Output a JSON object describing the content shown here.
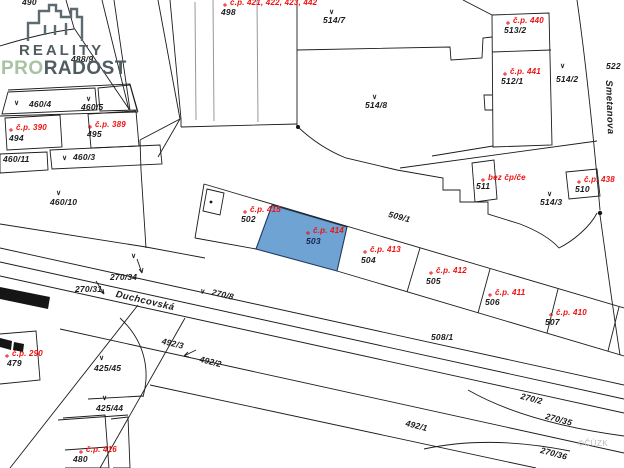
{
  "logo": {
    "line1": "REALITY",
    "pro": "PRO",
    "radost": "RADOST"
  },
  "map": {
    "highlight_color": "#6fa3d3",
    "highlight_border": "#1f3a5f",
    "line_color": "#1c1c1c",
    "red_label_color": "#ee1111",
    "land_use_symbol": "∨",
    "highlighted_parcel": "503",
    "highlighted_house_number": "č.p. 414",
    "labels": [
      {
        "t": "490",
        "x": 22,
        "y": -3
      },
      {
        "t": "488/9",
        "x": 71,
        "y": 54
      },
      {
        "t": "498",
        "x": 221,
        "y": 7
      },
      {
        "t": "č.p. 421, 422, 423, 442",
        "x": 230,
        "y": -2,
        "c": "r"
      },
      {
        "t": "514/7",
        "x": 323,
        "y": 15
      },
      {
        "t": "č.p. 440",
        "x": 513,
        "y": 16,
        "c": "r"
      },
      {
        "t": "513/2",
        "x": 504,
        "y": 25
      },
      {
        "t": "č.p. 441",
        "x": 510,
        "y": 67,
        "c": "r"
      },
      {
        "t": "512/1",
        "x": 501,
        "y": 76
      },
      {
        "t": "514/2",
        "x": 556,
        "y": 74
      },
      {
        "t": "522",
        "x": 606,
        "y": 61
      },
      {
        "t": "Smetanova",
        "x": 614,
        "y": 80,
        "r": 88,
        "c": "s"
      },
      {
        "t": "514/8",
        "x": 365,
        "y": 100
      },
      {
        "t": "460/4",
        "x": 29,
        "y": 99
      },
      {
        "t": "460/5",
        "x": 81,
        "y": 102
      },
      {
        "t": "č.p. 390",
        "x": 16,
        "y": 123,
        "c": "r"
      },
      {
        "t": "494",
        "x": 9,
        "y": 133
      },
      {
        "t": "č.p. 389",
        "x": 95,
        "y": 120,
        "c": "r"
      },
      {
        "t": "495",
        "x": 87,
        "y": 129
      },
      {
        "t": "460/11",
        "x": 3,
        "y": 154
      },
      {
        "t": "460/3",
        "x": 73,
        "y": 152
      },
      {
        "t": "460/10",
        "x": 50,
        "y": 197
      },
      {
        "t": "270/34",
        "x": 110,
        "y": 272
      },
      {
        "t": "270/31",
        "x": 75,
        "y": 284
      },
      {
        "t": "Duchcovská",
        "x": 117,
        "y": 289,
        "r": 13,
        "c": "s"
      },
      {
        "t": "270/8",
        "x": 213,
        "y": 287,
        "r": 13
      },
      {
        "t": "č.p. 415",
        "x": 250,
        "y": 205,
        "c": "r"
      },
      {
        "t": "502",
        "x": 241,
        "y": 214
      },
      {
        "t": "č.p. 414",
        "x": 313,
        "y": 226,
        "c": "r"
      },
      {
        "t": "503",
        "x": 306,
        "y": 236,
        "c": "d"
      },
      {
        "t": "509/1",
        "x": 390,
        "y": 209,
        "r": 15
      },
      {
        "t": "č.p. 413",
        "x": 370,
        "y": 245,
        "c": "r"
      },
      {
        "t": "504",
        "x": 361,
        "y": 255
      },
      {
        "t": "č.p. 412",
        "x": 436,
        "y": 266,
        "c": "r"
      },
      {
        "t": "505",
        "x": 426,
        "y": 276
      },
      {
        "t": "č.p. 411",
        "x": 495,
        "y": 288,
        "c": "r"
      },
      {
        "t": "506",
        "x": 485,
        "y": 297
      },
      {
        "t": "č.p. 410",
        "x": 556,
        "y": 308,
        "c": "r"
      },
      {
        "t": "507",
        "x": 545,
        "y": 317
      },
      {
        "t": "508/1",
        "x": 431,
        "y": 332
      },
      {
        "t": "bez čp/če",
        "x": 488,
        "y": 173,
        "c": "r"
      },
      {
        "t": "511",
        "x": 476,
        "y": 181
      },
      {
        "t": "č.p. 438",
        "x": 584,
        "y": 175,
        "c": "r"
      },
      {
        "t": "510",
        "x": 575,
        "y": 184
      },
      {
        "t": "514/3",
        "x": 540,
        "y": 197
      },
      {
        "t": "č.p. 290",
        "x": 12,
        "y": 349,
        "c": "r"
      },
      {
        "t": "479",
        "x": 7,
        "y": 358
      },
      {
        "t": "425/45",
        "x": 94,
        "y": 363
      },
      {
        "t": "425/44",
        "x": 96,
        "y": 403
      },
      {
        "t": "č.p. 416",
        "x": 86,
        "y": 445,
        "c": "r"
      },
      {
        "t": "480",
        "x": 73,
        "y": 454
      },
      {
        "t": "492/3",
        "x": 163,
        "y": 336,
        "r": 13
      },
      {
        "t": "492/2",
        "x": 201,
        "y": 354,
        "r": 14
      },
      {
        "t": "492/1",
        "x": 407,
        "y": 418,
        "r": 14
      },
      {
        "t": "270/2",
        "x": 522,
        "y": 391,
        "r": 14
      },
      {
        "t": "270/35",
        "x": 547,
        "y": 411,
        "r": 15
      },
      {
        "t": "270/36",
        "x": 542,
        "y": 445,
        "r": 15
      },
      {
        "t": "©ČÚZK",
        "x": 578,
        "y": 439,
        "c": "w"
      }
    ],
    "symbols": [
      {
        "x": 329,
        "y": 8
      },
      {
        "x": 560,
        "y": 62
      },
      {
        "x": 14,
        "y": 99
      },
      {
        "x": 86,
        "y": 95
      },
      {
        "x": 62,
        "y": 154
      },
      {
        "x": 56,
        "y": 189
      },
      {
        "x": 131,
        "y": 252
      },
      {
        "x": 201,
        "y": 287,
        "r": 13
      },
      {
        "x": 547,
        "y": 190
      },
      {
        "x": 372,
        "y": 93
      },
      {
        "x": 99,
        "y": 354
      },
      {
        "x": 102,
        "y": 394
      }
    ]
  }
}
